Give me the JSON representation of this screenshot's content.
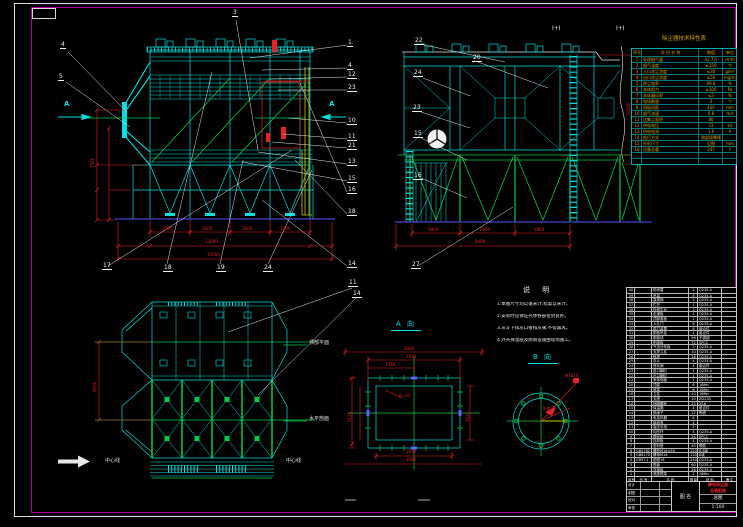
{
  "labels": {
    "section_a": "A 向",
    "section_b": "B 向",
    "dir_a": "A",
    "elev": "Ⅰ+Ⅰ",
    "plan_top": "顶部平面",
    "plan_bottom": "水平剖面",
    "centerline": "中心线"
  },
  "balloons": {
    "front_left": [
      "4",
      "5"
    ],
    "front_top": "3",
    "front_right": [
      "1",
      "4",
      "12",
      "23",
      "10",
      "11",
      "21",
      "13",
      "15",
      "16",
      "18",
      "14"
    ],
    "front_bottom": [
      "17",
      "18",
      "19",
      "24"
    ],
    "side_left": [
      "22",
      "24",
      "23",
      "15",
      "16"
    ],
    "side_top": "20",
    "side_bottom": "27",
    "plan": [
      "11",
      "14"
    ]
  },
  "dims": {
    "front_bay": "3000",
    "front_total1": "13000",
    "front_total2": "15000",
    "front_height": "7500",
    "side_bay": "2800",
    "side_total": "8400",
    "side_height": "10000",
    "a_top1": "3080",
    "a_top2": "2830",
    "a_top3": "1330",
    "a_bot1": "2830",
    "a_bot2": "3080",
    "a_left": "2124",
    "a_right": "1624",
    "a_note": "δ=10",
    "b_dia": "Φ1020",
    "b_holes": "8-Φ18",
    "plan_height": "9000"
  },
  "notes": {
    "title": "说  明",
    "items": [
      "1.本图尺寸均以毫米计,标高以米计。",
      "2.安装时应保证壳体各部密封良好。",
      "3.灰斗下排灰口接排灰阀,不得漏风。",
      "4.外壳保温层及防雨设施由现场施工。"
    ]
  },
  "spec_table": {
    "title": "除尘器技术特性表",
    "headers": [
      "序号",
      "项 目 名 称",
      "数值",
      "单位"
    ],
    "rows": [
      {
        "n": "1",
        "name": "处理烟气量",
        "v": "42.7万",
        "u": "m³/h"
      },
      {
        "n": "2",
        "name": "烟气温度",
        "v": "≤150",
        "u": "℃"
      },
      {
        "n": "3",
        "name": "入口含尘浓度",
        "v": "≤30",
        "u": "g/m³"
      },
      {
        "n": "4",
        "name": "出口含尘浓度",
        "v": "≤50",
        "u": "mg/m³"
      },
      {
        "n": "5",
        "name": "除尘效率",
        "v": "99.8",
        "u": "%"
      },
      {
        "n": "6",
        "name": "本体阻力",
        "v": "≤300",
        "u": "Pa"
      },
      {
        "n": "7",
        "name": "本体漏风率",
        "v": "≤3",
        "u": "%"
      },
      {
        "n": "8",
        "name": "电场数量",
        "v": "3",
        "u": "个"
      },
      {
        "n": "9",
        "name": "同极间距",
        "v": "400",
        "u": "mm"
      },
      {
        "n": "10",
        "name": "烟气流速",
        "v": "0.8",
        "u": "m/s"
      },
      {
        "n": "11",
        "name": "比集尘面积",
        "v": "80",
        "u": ""
      },
      {
        "n": "12",
        "name": "供电电压",
        "v": "72",
        "u": "kV"
      },
      {
        "n": "13",
        "name": "供电电流",
        "v": "1.6",
        "u": "A"
      },
      {
        "n": "14",
        "name": "振打方式",
        "v": "侧部挠臂锤",
        "u": ""
      },
      {
        "n": "15",
        "name": "外形尺寸",
        "v": "见图",
        "u": "mm"
      },
      {
        "n": "16",
        "name": "设备总重",
        "v": "247",
        "u": "t"
      },
      {
        "n": "",
        "name": "",
        "v": "",
        "u": ""
      },
      {
        "n": "",
        "name": "",
        "v": "",
        "u": ""
      }
    ]
  },
  "bom": {
    "headers": [
      "序号",
      "代 号",
      "名  称",
      "数量",
      "材 料",
      "备注"
    ],
    "rows": [
      {
        "n": "40",
        "c": "",
        "m": "防雨罩",
        "q": "2",
        "t": "Q235-A",
        "r": ""
      },
      {
        "n": "39",
        "c": "",
        "m": "吊耳",
        "q": "8",
        "t": "Q235-A",
        "r": ""
      },
      {
        "n": "38",
        "c": "",
        "m": "直爬梯",
        "q": "2",
        "t": "Q235-A",
        "r": ""
      },
      {
        "n": "37",
        "c": "",
        "m": "栏杆",
        "q": "1",
        "t": "Q235-A",
        "r": ""
      },
      {
        "n": "36",
        "c": "",
        "m": "检修平台",
        "q": "2",
        "t": "Q235-A",
        "r": ""
      },
      {
        "n": "35",
        "c": "",
        "m": "走道板",
        "q": "1",
        "t": "Q235-A",
        "r": ""
      },
      {
        "n": "34",
        "c": "",
        "m": "顶部盖板",
        "q": "1",
        "t": "Q235-A",
        "r": ""
      },
      {
        "n": "33",
        "c": "",
        "m": "人孔门",
        "q": "6",
        "t": "Q235-A",
        "r": ""
      },
      {
        "n": "32",
        "c": "",
        "m": "振打装置",
        "q": "8",
        "t": "组合件",
        "r": ""
      },
      {
        "n": "31",
        "c": "",
        "m": "阴极吊挂",
        "q": "4",
        "t": "组合件",
        "r": ""
      },
      {
        "n": "30",
        "c": "",
        "m": "阴极线",
        "q": "96",
        "t": "不锈钢",
        "r": ""
      },
      {
        "n": "29",
        "c": "",
        "m": "阳极板",
        "q": "72",
        "t": "SPCC",
        "r": ""
      },
      {
        "n": "28",
        "c": "",
        "m": "气流分布板",
        "q": "2",
        "t": "Q235-A",
        "r": ""
      },
      {
        "n": "27",
        "c": "",
        "m": "支撑立柱",
        "q": "10",
        "t": "Q235-A",
        "r": ""
      },
      {
        "n": "26",
        "c": "",
        "m": "斜撑",
        "q": "16",
        "t": "Q235-A",
        "r": ""
      },
      {
        "n": "25",
        "c": "",
        "m": "灰斗",
        "q": "4",
        "t": "Q235-A",
        "r": ""
      },
      {
        "n": "24",
        "c": "",
        "m": "排灰阀",
        "q": "4",
        "t": "组合件",
        "r": ""
      },
      {
        "n": "23",
        "c": "",
        "m": "进口喇叭",
        "q": "1",
        "t": "Q235-A",
        "r": ""
      },
      {
        "n": "22",
        "c": "",
        "m": "出口喇叭",
        "q": "1",
        "t": "Q235-A",
        "r": ""
      },
      {
        "n": "21",
        "c": "",
        "m": "壳体侧板",
        "q": "2",
        "t": "Q235-A",
        "r": ""
      },
      {
        "n": "20",
        "c": "",
        "m": "顶梁",
        "q": "6",
        "t": "16Mn",
        "r": ""
      },
      {
        "n": "19",
        "c": "",
        "m": "底梁",
        "q": "6",
        "t": "16Mn",
        "r": ""
      },
      {
        "n": "18",
        "c": "",
        "m": "立柱",
        "q": "10",
        "t": "16Mn",
        "r": ""
      },
      {
        "n": "17",
        "c": "",
        "m": "支座",
        "q": "10",
        "t": "ZG230",
        "r": ""
      },
      {
        "n": "16",
        "c": "",
        "m": "地脚螺栓",
        "q": "20",
        "t": "35#",
        "r": ""
      },
      {
        "n": "15",
        "c": "",
        "m": "保温箱",
        "q": "4",
        "t": "组合件",
        "r": ""
      },
      {
        "n": "14",
        "c": "",
        "m": "绝缘子",
        "q": "12",
        "t": "陶瓷",
        "r": ""
      },
      {
        "n": "13",
        "c": "",
        "m": "电加热器",
        "q": "8",
        "t": "",
        "r": ""
      },
      {
        "n": "12",
        "c": "",
        "m": "接线盒",
        "q": "4",
        "t": "",
        "r": ""
      },
      {
        "n": "11",
        "c": "",
        "m": "高压引线",
        "q": "2",
        "t": "",
        "r": ""
      },
      {
        "n": "10",
        "c": "",
        "m": "均压环",
        "q": "4",
        "t": "Q235-A",
        "r": ""
      },
      {
        "n": "9",
        "c": "",
        "m": "槽形板",
        "q": "24",
        "t": "SPCC",
        "r": ""
      },
      {
        "n": "8",
        "c": "",
        "m": "挡风板",
        "q": "4",
        "t": "Q235-A",
        "r": ""
      },
      {
        "n": "7",
        "c": "",
        "m": "密封垫",
        "q": "40",
        "t": "橡胶",
        "r": ""
      },
      {
        "n": "6",
        "c": "GB5782",
        "m": "螺栓M16×50",
        "q": "120",
        "t": "8.8级",
        "r": ""
      },
      {
        "n": "5",
        "c": "GB6170",
        "m": "螺母M16",
        "q": "120",
        "t": "8级",
        "r": ""
      },
      {
        "n": "4",
        "c": "GB97.1",
        "m": "垫圈16",
        "q": "240",
        "t": "Q235-A",
        "r": ""
      },
      {
        "n": "3",
        "c": "",
        "m": "筋板",
        "q": "60",
        "t": "Q235-A",
        "r": ""
      },
      {
        "n": "2",
        "c": "",
        "m": "连接板",
        "q": "28",
        "t": "Q235-A",
        "r": ""
      },
      {
        "n": "1",
        "c": "",
        "m": "底座框架",
        "q": "1",
        "t": "16Mn",
        "r": ""
      }
    ]
  },
  "title_block": {
    "sign_rows": [
      {
        "a": "设计",
        "b": ""
      },
      {
        "a": "制图",
        "b": ""
      },
      {
        "a": "校对",
        "b": ""
      },
      {
        "a": "审核",
        "b": ""
      }
    ],
    "middle_label": "图 名",
    "stamp_line1": "静电除尘器",
    "stamp_line2": "总装配图",
    "doc_type": "总图",
    "scale": "1:100"
  }
}
